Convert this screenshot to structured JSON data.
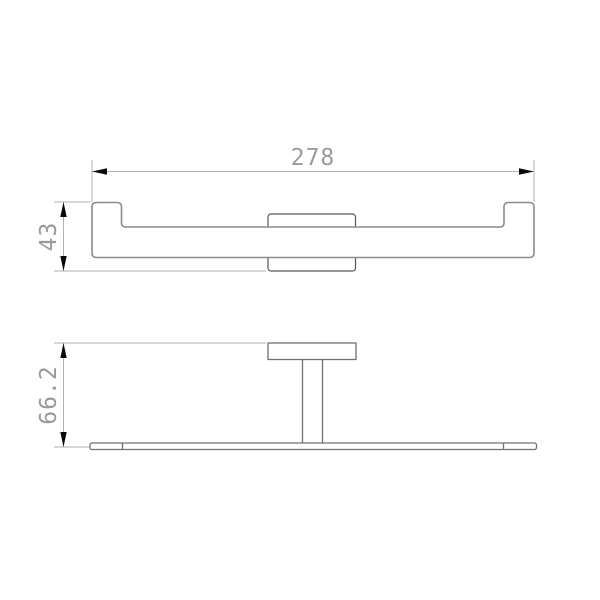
{
  "page": {
    "background": "#ffffff"
  },
  "drawing": {
    "type": "technical-dimension-drawing",
    "views": {
      "front": {
        "dim_width_label": "278",
        "dim_height_label": "43"
      },
      "plan": {
        "dim_depth_label": "66.2"
      }
    },
    "colors": {
      "bar_outline": "#8c8c8c",
      "plate_outline": "#565656",
      "plan_outline": "#707070",
      "dimension_line": "#b2b2b2",
      "arrow": "#0a0a0a",
      "label_text": "#9a9a9a",
      "shape_fill": "#ffffff"
    }
  }
}
